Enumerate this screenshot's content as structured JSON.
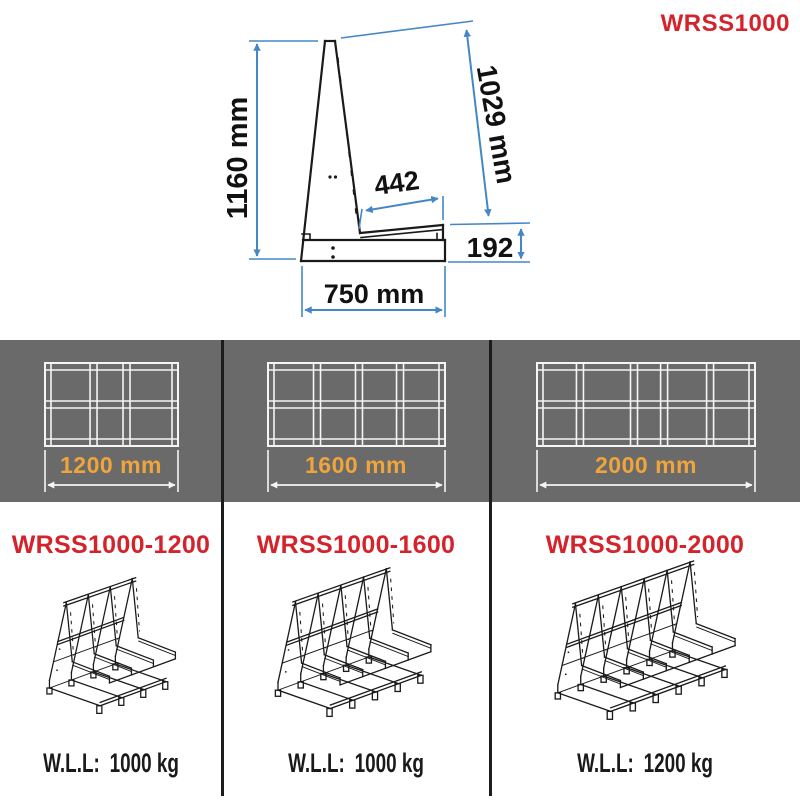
{
  "header": {
    "product_code": "WRSS1000"
  },
  "side_view": {
    "dim_height": "1160 mm",
    "dim_slope": "1029 mm",
    "dim_ledge": "442",
    "dim_back_height": "192",
    "dim_base_width": "750 mm"
  },
  "band": {
    "items": [
      {
        "width_label": "1200 mm"
      },
      {
        "width_label": "1600 mm"
      },
      {
        "width_label": "2000 mm"
      }
    ]
  },
  "models": [
    {
      "name": "WRSS1000-1200",
      "wll_label": "W.L.L:",
      "wll_value": "1000 kg",
      "aframe_count": 4
    },
    {
      "name": "WRSS1000-1600",
      "wll_label": "W.L.L:",
      "wll_value": "1000 kg",
      "aframe_count": 5
    },
    {
      "name": "WRSS1000-2000",
      "wll_label": "W.L.L:",
      "wll_value": "1200 kg",
      "aframe_count": 6
    }
  ],
  "colors": {
    "accent_red": "#d5232b",
    "accent_orange": "#f0a43c",
    "dimension_blue": "#4587c6",
    "band_gray": "#6a6a6a",
    "line_black": "#1a1a1a"
  }
}
